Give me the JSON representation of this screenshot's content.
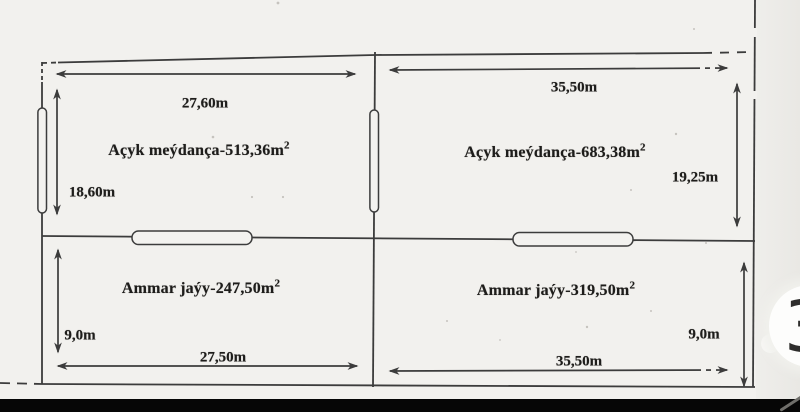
{
  "plan": {
    "plots": [
      {
        "label": "Açyk meýdança-513,36m",
        "area_sup": "2",
        "width": "27,60m",
        "height": "18,60m"
      },
      {
        "label": "Açyk meýdança-683,38m",
        "area_sup": "2",
        "width": "35,50m",
        "height": "19,25m"
      },
      {
        "label": "Ammar jaýy-247,50m",
        "area_sup": "2",
        "width": "27,50m",
        "height": "9,0m"
      },
      {
        "label": "Ammar jaýy-319,50m",
        "area_sup": "2",
        "width": "35,50m",
        "height": "9,0m"
      }
    ],
    "colors": {
      "paper": "#f2f1ee",
      "line": "#3c3c3c",
      "text": "#1e1d1b",
      "bottom_bar": "#060606",
      "bubble_bg": "#fdfdfc"
    }
  },
  "overlay": {
    "bubble_glyph": "3"
  }
}
